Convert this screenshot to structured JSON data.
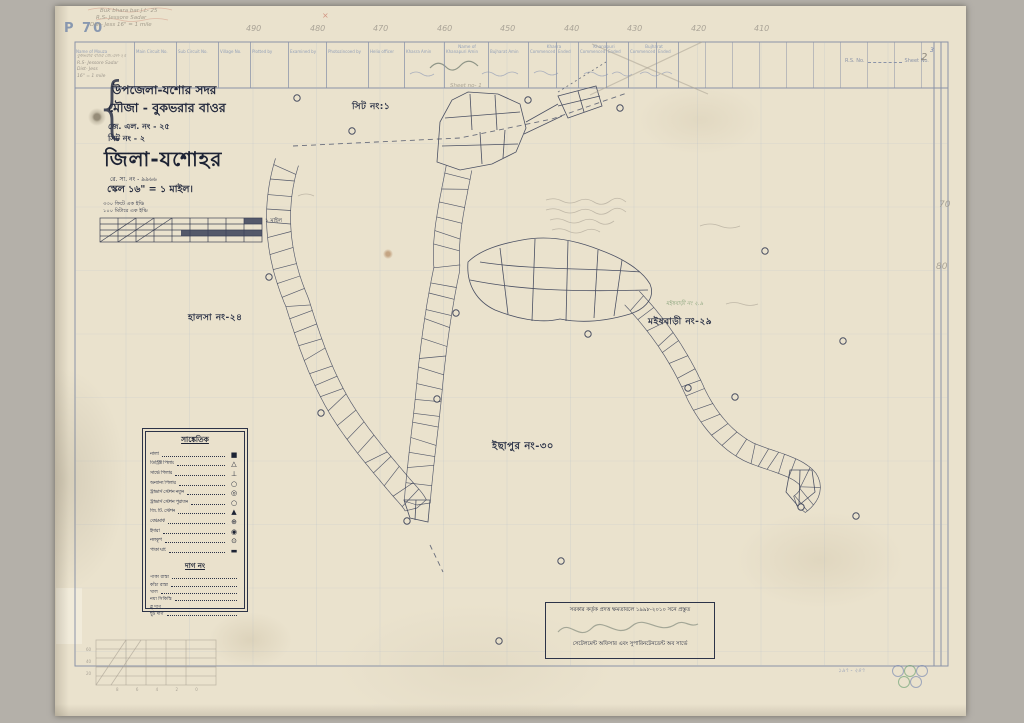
{
  "meta": {
    "corner_code": "P 70"
  },
  "notes": {
    "top_left": [
      "Buk bhara bar  J.L- 25",
      "R.S- Jessore Sadar",
      "Dist- Jess   16\" = 1 mile"
    ],
    "red_mark": "×",
    "sheet_pencil": "Sheet no- 1",
    "footer_blue": "১৯৭ - ২৪৭"
  },
  "grid": {
    "top_numbers": [
      {
        "t": "490",
        "x": 246
      },
      {
        "t": "480",
        "x": 310
      },
      {
        "t": "470",
        "x": 373
      },
      {
        "t": "460",
        "x": 437
      },
      {
        "t": "450",
        "x": 500
      },
      {
        "t": "440",
        "x": 564
      },
      {
        "t": "430",
        "x": 627
      },
      {
        "t": "420",
        "x": 691
      },
      {
        "t": "410",
        "x": 754
      }
    ],
    "right_numbers": [
      {
        "t": "70",
        "x": 939,
        "y": 200
      },
      {
        "t": "80",
        "x": 936,
        "y": 262
      }
    ]
  },
  "strip": {
    "columns": [
      {
        "label": "Name of Mouza",
        "w": 60
      },
      {
        "label": "Main Circuit No.",
        "w": 42
      },
      {
        "label": "Sub Circuit No.",
        "w": 42
      },
      {
        "label": "Village No.",
        "w": 32
      },
      {
        "label": "Plotted by",
        "w": 38
      },
      {
        "label": "Examined by",
        "w": 38
      },
      {
        "label": "Photozincoed by",
        "w": 42
      },
      {
        "label": "Helio officer",
        "w": 36
      },
      {
        "label": "Khasra Amin",
        "w": 40
      },
      {
        "label": "Khanapuri Amin",
        "w": 44
      },
      {
        "label": "Bujharat Amin",
        "w": 40
      },
      {
        "label": "Commenced",
        "w": 28
      },
      {
        "label": "Ended",
        "w": 22
      },
      {
        "label": "Commenced",
        "w": 28
      },
      {
        "label": "Ended",
        "w": 22
      },
      {
        "label": "Commenced",
        "w": 28
      },
      {
        "label": "Ended",
        "w": 22
      }
    ],
    "groups": [
      {
        "t": "Name of",
        "x": 467
      },
      {
        "t": "Khasra",
        "x": 554
      },
      {
        "t": "Khanapuri",
        "x": 604
      },
      {
        "t": "Bujharat",
        "x": 654
      }
    ],
    "entries": [
      "বুকভরার বাওর জে.এল-২৫",
      "R.S- Jessore Sadar",
      "Dist- Jess",
      "16\" = 1 mile"
    ],
    "rs_label": "R.S. No.",
    "sheet_label": "Sheet No.",
    "sheet_value": "2",
    "sheet_alt": "3"
  },
  "title_block": {
    "line1": "উপজেলা-যশোর সদর",
    "line2": "মৌজা - বুকভরার বাওর",
    "line3": "জে. এল. নং - ২৫",
    "line4": "সিট নং - ২",
    "district": "জিলা-যশোহর",
    "reg": "রে. সা. নং - ৯৯৬৬",
    "scale": "স্কেল ১৬\" = ১ মাইল।",
    "scale_sub1": "৩৩০ ফিটে এক ইঞ্চি",
    "scale_sub2": "১০০ মিটারে এক ইঞ্চি",
    "scale_bar_label": "১ মাইল"
  },
  "labels": {
    "printed": [
      {
        "t": "সিট নং:১",
        "x": 352,
        "y": 99,
        "s": 9
      },
      {
        "t": "হালসা নং-২৪",
        "x": 188,
        "y": 310,
        "s": 9
      },
      {
        "t": "মইষবাড়ী নং-২৯",
        "x": 648,
        "y": 314,
        "s": 9
      },
      {
        "t": "ইছাপুর নং-৩০",
        "x": 492,
        "y": 439,
        "s": 10
      }
    ],
    "pencil": [
      {
        "t": "মইষবাড়ী নং ২.৯",
        "x": 666,
        "y": 301
      }
    ]
  },
  "legend": {
    "title": "সাঙ্কেতিক",
    "items": [
      {
        "name": "নালা",
        "sym": "■"
      },
      {
        "name": "ডিস্ট্রিক্ট পিলার",
        "sym": "△"
      },
      {
        "name": "সার্ভে পিলার",
        "sym": "⊥"
      },
      {
        "name": "অন্যান্য পিলার",
        "sym": "○"
      },
      {
        "name": "ট্রাভার্স স্টেশন নতুন",
        "sym": "◎"
      },
      {
        "name": "ট্রাভার্স স্টেশন পুরাতন",
        "sym": "○"
      },
      {
        "name": "জি. টি. স্টেশন",
        "sym": "▲"
      },
      {
        "name": "বেঞ্চমার্ক",
        "sym": "⊕"
      },
      {
        "name": "ইদারা",
        "sym": "◉"
      },
      {
        "name": "নলকূপ",
        "sym": "⊙"
      },
      {
        "name": "পাকা ঘাট",
        "sym": "▬"
      }
    ],
    "section2": {
      "title": "দাগ নং",
      "rows": [
        "পাকা রাস্তা",
        "কাঁচা রাস্তা",
        "খাল",
        "নয়া সিকিস্তি",
        "ব্লু দাগ",
        "ছুট দাগ"
      ]
    }
  },
  "stamp": {
    "line1": "সরকার কর্তৃক প্রদত্ত ক্ষমতাবলে ১৯৯৮-২০১০ সনে প্রস্তুত",
    "line3": "সেটেলমেন্ট অফিসার এবং সুপারিনটেনডেন্ট অব সার্ভে"
  },
  "pencil_scale": {
    "left": "60 40 20",
    "bottom": "8 6 4 2 0"
  },
  "colors": {
    "ink": "#3a4158",
    "pencil": "#9a948a",
    "paper": "#eae2cd",
    "red": "#c2614f",
    "green": "#6a8f62",
    "blue_note": "#7787b0"
  }
}
